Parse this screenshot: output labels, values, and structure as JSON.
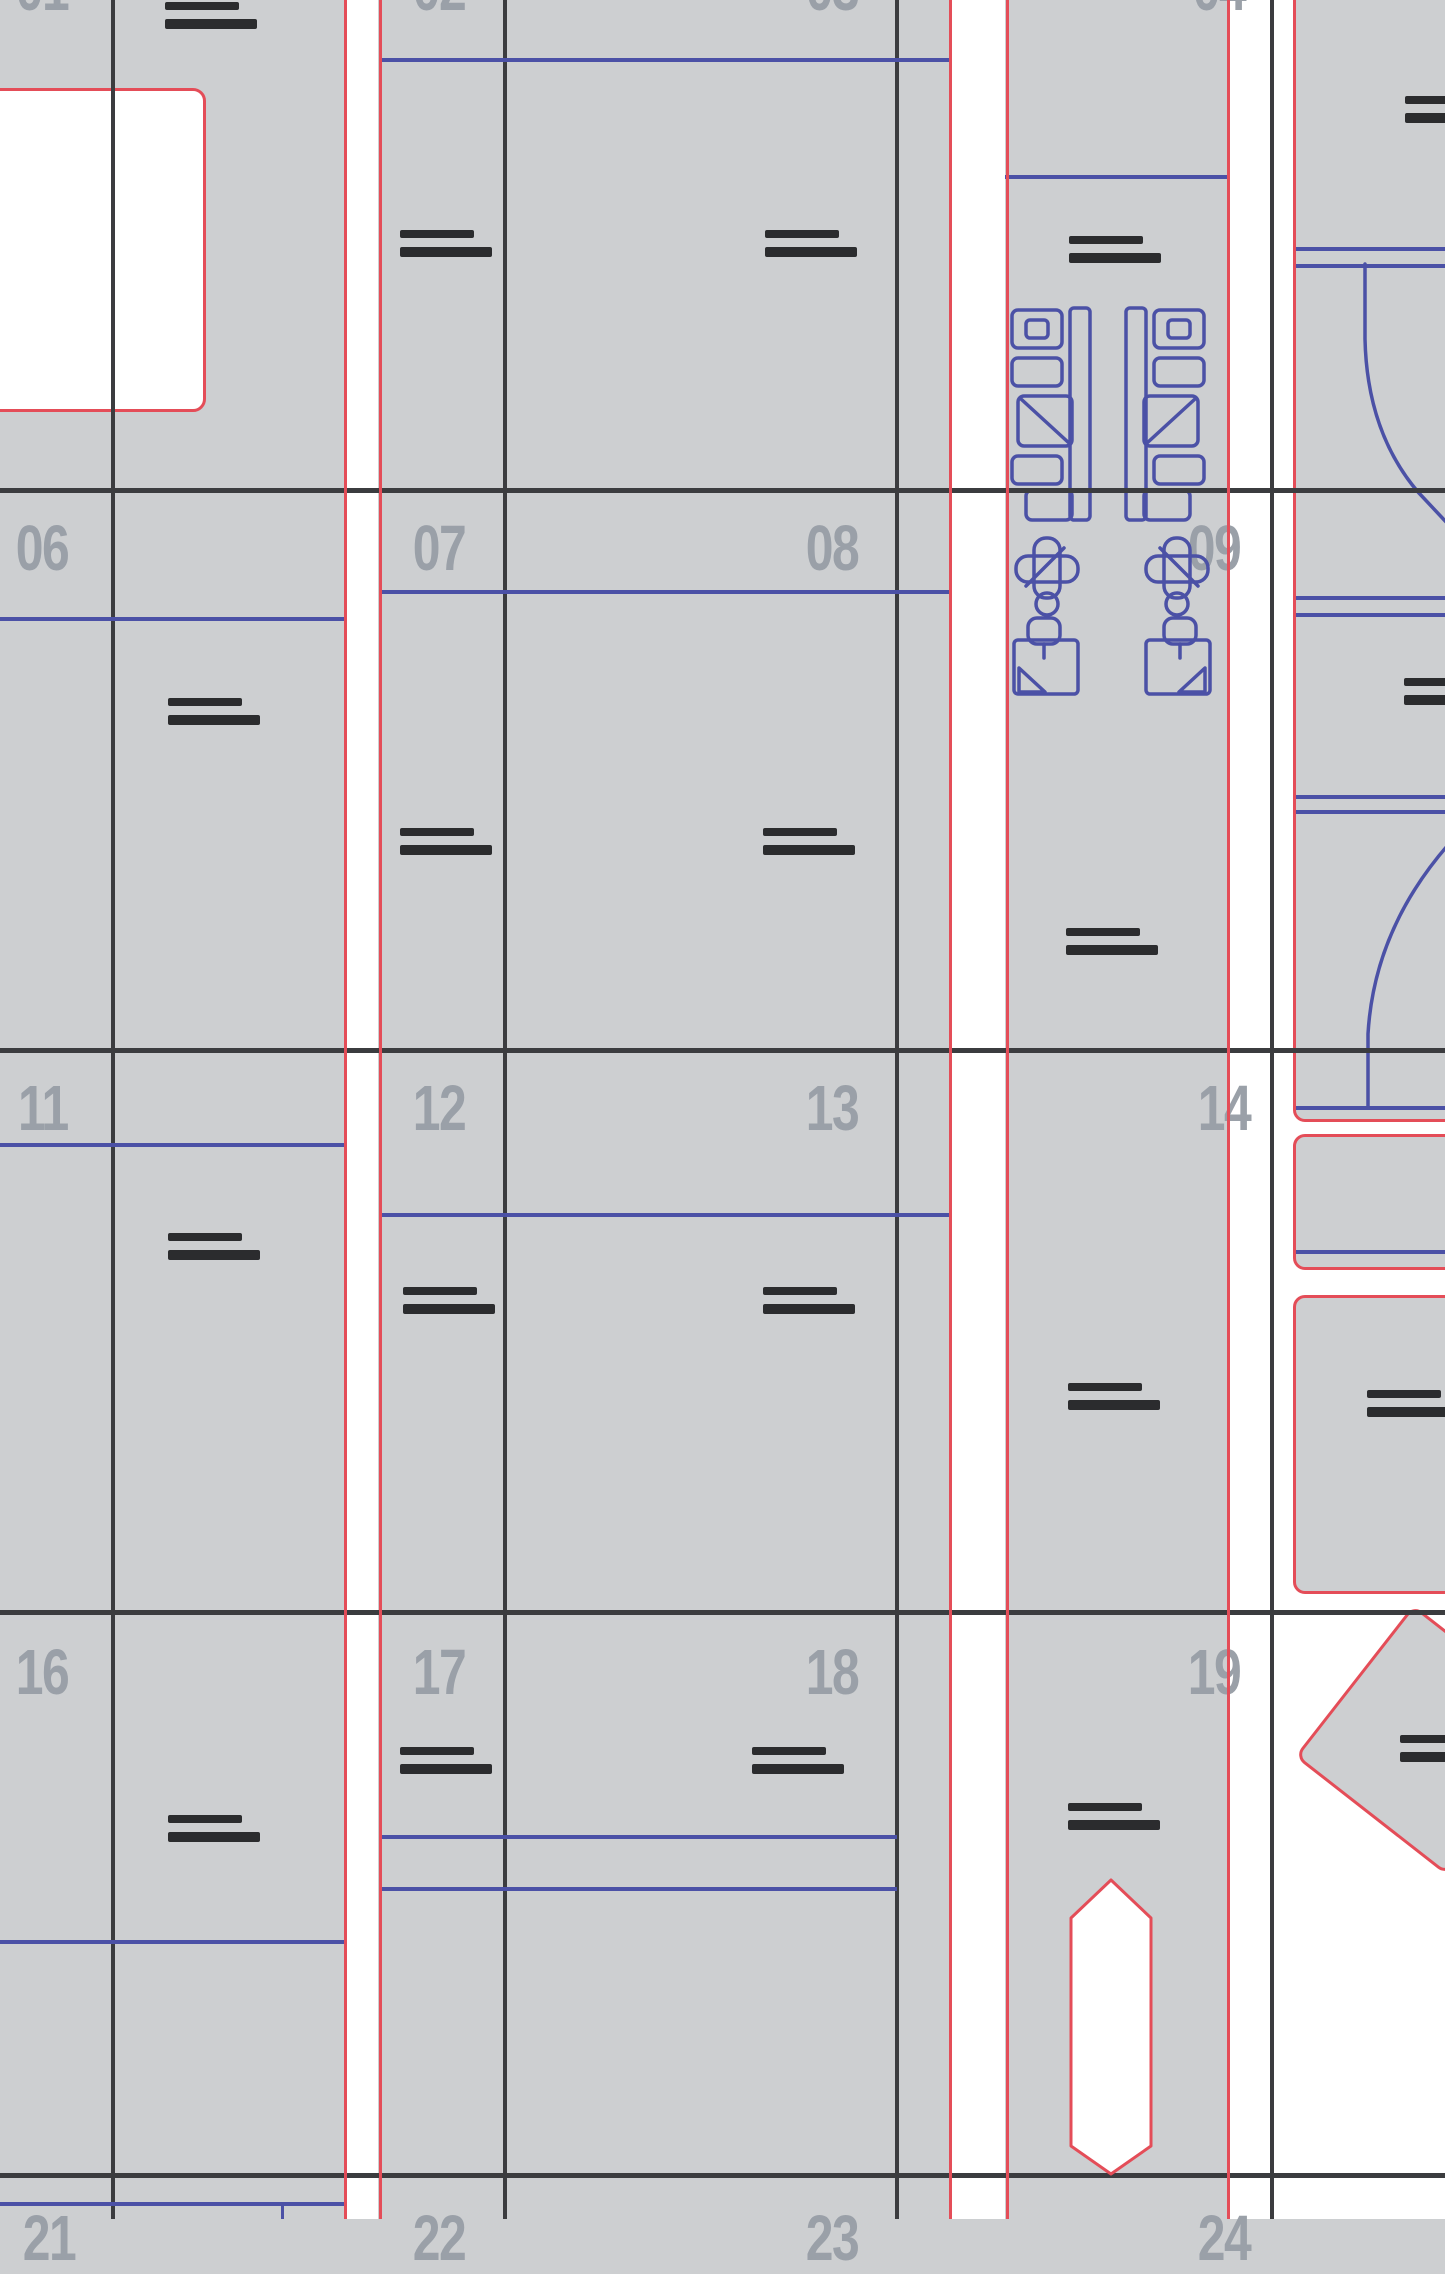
{
  "meta": {
    "description": "cutting-layout-sheet",
    "colors": {
      "background_gray": "#cdcfd1",
      "white": "#ffffff",
      "grid_dark": "#3b3c3f",
      "cut_red": "#e44d58",
      "crease_blue": "#4b51a6",
      "mark_dark": "#2b2c2e",
      "label_gray": "#9aa0a8"
    }
  },
  "grid": {
    "dark_verticals": [
      111,
      503,
      895,
      1270
    ],
    "dark_horizontals": [
      488,
      1048,
      1610,
      2173
    ],
    "red_verticals": [
      344,
      379,
      949,
      1006,
      1227
    ],
    "white_channels": [
      {
        "x": 346,
        "y": 0,
        "w": 32,
        "h": 2219
      },
      {
        "x": 951,
        "y": 0,
        "w": 54,
        "h": 2219
      },
      {
        "x": 1229,
        "y": 0,
        "w": 216,
        "h": 2219
      }
    ]
  },
  "cell_labels": [
    {
      "text": "01",
      "right": 68,
      "top": -44,
      "partial": true
    },
    {
      "text": "02",
      "right": 465,
      "top": -44,
      "partial": true
    },
    {
      "text": "03",
      "right": 858,
      "top": -44,
      "partial": true
    },
    {
      "text": "04",
      "right": 1245,
      "top": -44,
      "partial": true
    },
    {
      "text": "06",
      "right": 68,
      "top": 516,
      "partial": false
    },
    {
      "text": "07",
      "right": 465,
      "top": 516,
      "partial": false
    },
    {
      "text": "08",
      "right": 858,
      "top": 516,
      "partial": false
    },
    {
      "text": "09",
      "right": 1240,
      "top": 516,
      "partial": false
    },
    {
      "text": "11",
      "right": 68,
      "top": 1076,
      "partial": false
    },
    {
      "text": "12",
      "right": 465,
      "top": 1076,
      "partial": false
    },
    {
      "text": "13",
      "right": 858,
      "top": 1076,
      "partial": false
    },
    {
      "text": "14",
      "right": 1250,
      "top": 1076,
      "partial": false
    },
    {
      "text": "16",
      "right": 68,
      "top": 1640,
      "partial": false
    },
    {
      "text": "17",
      "right": 465,
      "top": 1640,
      "partial": false
    },
    {
      "text": "18",
      "right": 858,
      "top": 1640,
      "partial": false
    },
    {
      "text": "19",
      "right": 1240,
      "top": 1640,
      "partial": false
    },
    {
      "text": "21",
      "right": 75,
      "top": 2206,
      "partial": true
    },
    {
      "text": "22",
      "right": 465,
      "top": 2206,
      "partial": true
    },
    {
      "text": "23",
      "right": 858,
      "top": 2206,
      "partial": true
    },
    {
      "text": "24",
      "right": 1250,
      "top": 2206,
      "partial": true
    }
  ],
  "registration_marks": [
    {
      "x": 165,
      "y": 2
    },
    {
      "x": 400,
      "y": 230
    },
    {
      "x": 765,
      "y": 230
    },
    {
      "x": 1069,
      "y": 236
    },
    {
      "x": 1405,
      "y": 96
    },
    {
      "x": 168,
      "y": 698
    },
    {
      "x": 400,
      "y": 828
    },
    {
      "x": 763,
      "y": 828
    },
    {
      "x": 1066,
      "y": 928
    },
    {
      "x": 1404,
      "y": 678
    },
    {
      "x": 168,
      "y": 1233
    },
    {
      "x": 403,
      "y": 1287
    },
    {
      "x": 763,
      "y": 1287
    },
    {
      "x": 1068,
      "y": 1383
    },
    {
      "x": 1367,
      "y": 1390
    },
    {
      "x": 168,
      "y": 1815
    },
    {
      "x": 400,
      "y": 1747
    },
    {
      "x": 752,
      "y": 1747
    },
    {
      "x": 1068,
      "y": 1803
    },
    {
      "x": 1400,
      "y": 1735
    }
  ],
  "blue_lines": {
    "horizontal": [
      {
        "x1": 381,
        "x2": 950,
        "y": 58
      },
      {
        "x1": 1005,
        "x2": 1227,
        "y": 175
      },
      {
        "x1": 1296,
        "x2": 1445,
        "y": 247
      },
      {
        "x1": 1296,
        "x2": 1445,
        "y": 264
      },
      {
        "x1": 381,
        "x2": 950,
        "y": 590
      },
      {
        "x1": 1296,
        "x2": 1445,
        "y": 596
      },
      {
        "x1": 1296,
        "x2": 1445,
        "y": 613
      },
      {
        "x1": 0,
        "x2": 345,
        "y": 617
      },
      {
        "x1": 1296,
        "x2": 1445,
        "y": 795
      },
      {
        "x1": 1296,
        "x2": 1445,
        "y": 810
      },
      {
        "x1": 1296,
        "x2": 1445,
        "y": 1106
      },
      {
        "x1": 0,
        "x2": 345,
        "y": 1143
      },
      {
        "x1": 381,
        "x2": 950,
        "y": 1213
      },
      {
        "x1": 1296,
        "x2": 1445,
        "y": 1250
      },
      {
        "x1": 381,
        "x2": 897,
        "y": 1835
      },
      {
        "x1": 381,
        "x2": 897,
        "y": 1887
      },
      {
        "x1": 0,
        "x2": 345,
        "y": 1940
      },
      {
        "x1": 0,
        "x2": 345,
        "y": 2202
      }
    ],
    "vertical": [
      {
        "x": 281,
        "y1": 2202,
        "y2": 2219
      }
    ]
  },
  "gray_shapes": [
    {
      "x": 1293,
      "y": -20,
      "w": 200,
      "h": 1136,
      "name": "right-panel-a"
    },
    {
      "x": 1293,
      "y": 1134,
      "w": 200,
      "h": 130,
      "name": "right-panel-b"
    },
    {
      "x": 1293,
      "y": 1295,
      "w": 200,
      "h": 293,
      "name": "right-panel-c"
    }
  ],
  "white_rects": [
    {
      "x": -16,
      "y": 88,
      "w": 216,
      "h": 318,
      "name": "cutout-window"
    }
  ],
  "vector_shapes": {
    "blue_arcs": [
      {
        "d": "M1365 264 L1365 339 Q1367 432 1418 492 L1448 524"
      },
      {
        "d": "M1448 845 Q1374 930 1368 1034 L1368 1106"
      }
    ],
    "pill": {
      "d": "M1111 1880 L1151 1918 L1151 2146 L1111 2174 L1071 2146 L1071 1918 Z"
    },
    "diamond": {
      "cx": 1430,
      "cy": 1740,
      "size": 190,
      "rotate": 38
    },
    "profiles": [
      {
        "tx": 1012,
        "ty": 308,
        "mirror": false
      },
      {
        "tx": 1012,
        "ty": 308,
        "mirror": true,
        "axis": 2216
      }
    ],
    "clovers": [
      {
        "tx": 1016,
        "ty": 538,
        "mirror": false
      },
      {
        "tx": 1016,
        "ty": 538,
        "mirror": true,
        "axis": 2224
      }
    ],
    "clipboards": [
      {
        "tx": 1014,
        "ty": 618,
        "mirror": false
      },
      {
        "tx": 1014,
        "ty": 618,
        "mirror": true,
        "axis": 2224
      }
    ]
  }
}
